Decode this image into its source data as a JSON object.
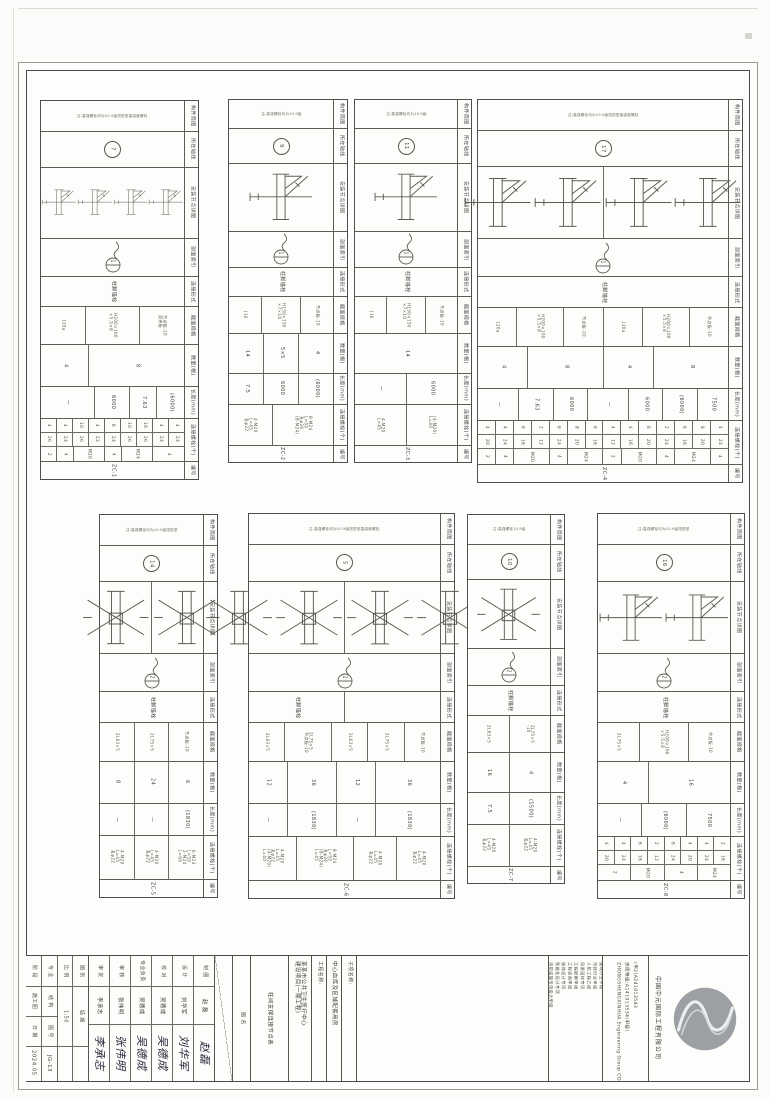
{
  "sheet": {
    "ink": "#4a4a48",
    "paper": "#fdfdfb",
    "logo_gray": "#9ca0a4"
  },
  "band_labels": [
    "构件简图",
    "所在轴线",
    "安装节点详图",
    "剖面索引",
    "连接形式",
    "截面规格",
    "数量(根)",
    "长度(mm)",
    "连接螺栓(个)",
    "编号"
  ],
  "tables": [
    {
      "x": 40,
      "y": 100,
      "w": 157,
      "h": 378,
      "axis": "7",
      "cut": "1",
      "note": "注:高强螺栓均为10.9级扭剪型高强度螺栓",
      "conn": [
        "柱脚锚栓"
      ],
      "sketch": {
        "type": "corner",
        "count": 4,
        "divider": false
      },
      "sections": [
        {
          "w": 1,
          "lines": [
            "[20a"
          ]
        },
        {
          "w": 1.2,
          "lines": [
            "H200×100",
            "×5.5×8"
          ]
        },
        {
          "w": 1,
          "lines": [
            "节点板-10",
            "双夹板"
          ]
        }
      ],
      "qty": [
        {
          "w": 1,
          "t": "4"
        },
        {
          "w": 2,
          "t": "8"
        }
      ],
      "len": [
        {
          "w": 1.6,
          "t": "—"
        },
        {
          "w": 1,
          "t": "6000"
        },
        {
          "w": 0.8,
          "t": "7.63"
        },
        {
          "w": 0.8,
          "t": "(6000)"
        }
      ],
      "bolts": {
        "style": "grid",
        "r1": [
          "4",
          "4",
          "10",
          "4",
          "6",
          "10",
          "16",
          "4",
          "4"
        ],
        "r2": [
          "20",
          "24",
          "20",
          "22",
          "24",
          "20",
          "20",
          "24",
          "24"
        ],
        "r3": [
          {
            "t": "2",
            "s": 1
          },
          {
            "t": "4",
            "s": 1
          },
          {
            "t": "M20",
            "s": 2
          },
          {
            "t": "4",
            "s": 1
          },
          {
            "t": "M24",
            "s": 2
          },
          {
            "t": "4",
            "s": 2
          }
        ]
      },
      "code": "ZC-1"
    },
    {
      "x": 228,
      "y": 99,
      "w": 118,
      "h": 362,
      "axis": "9",
      "cut": "1",
      "note": "注:高强螺栓均为10.9级",
      "conn": [
        "柱脚锚栓"
      ],
      "sketch": {
        "type": "corner",
        "count": 1,
        "divider": false
      },
      "sections": [
        {
          "w": 1,
          "lines": [
            "[16"
          ]
        },
        {
          "w": 1.2,
          "lines": [
            "H150×150",
            "×7×10"
          ]
        },
        {
          "w": 1,
          "lines": [
            "节点板-10"
          ]
        }
      ],
      "qty": [
        {
          "w": 1,
          "t": "14"
        },
        {
          "w": 1,
          "t": "5×5"
        },
        {
          "w": 1,
          "t": "4"
        }
      ],
      "len": [
        {
          "w": 1,
          "t": "7.5"
        },
        {
          "w": 1,
          "t": "6000"
        },
        {
          "w": 1,
          "t": "(6000)"
        }
      ],
      "bolts": {
        "style": "text",
        "cells": [
          {
            "w": 1,
            "lines": [
              "4-M20",
              "L=45",
              "孔φ22"
            ]
          },
          {
            "w": 1.4,
            "lines": [
              "8-M24",
              "L=50",
              "孔φ26",
              "(8-M24)"
            ]
          }
        ]
      },
      "code": "ZC-2"
    },
    {
      "x": 354,
      "y": 99,
      "w": 116,
      "h": 362,
      "axis": "11",
      "cut": "1",
      "note": "注:高强螺栓均为10.9级",
      "conn": [
        "柱脚锚栓"
      ],
      "sketch": {
        "type": "corner",
        "count": 1,
        "divider": false
      },
      "sections": [
        {
          "w": 1,
          "lines": [
            "[16"
          ]
        },
        {
          "w": 1.2,
          "lines": [
            "H150×150",
            "×7×10"
          ]
        },
        {
          "w": 1,
          "lines": [
            "节点板-10"
          ]
        }
      ],
      "qty": [
        {
          "w": 1,
          "t": "14"
        }
      ],
      "len": [
        {
          "w": 1,
          "t": "—"
        },
        {
          "w": 1,
          "t": "6000"
        }
      ],
      "bolts": {
        "style": "text",
        "cells": [
          {
            "w": 1,
            "lines": [
              "4-M20",
              "L=45"
            ]
          },
          {
            "w": 1,
            "lines": [
              "(4-M20)",
              "L=40"
            ]
          }
        ]
      },
      "code": "ZC-3"
    },
    {
      "x": 477,
      "y": 99,
      "w": 264,
      "h": 382,
      "axis": "17",
      "cut": "1",
      "note": "注:高强螺栓均为10.9级扭剪型高强度螺栓",
      "conn": [
        "柱脚锚栓"
      ],
      "sketch": {
        "type": "corner",
        "count": 4,
        "divider": true
      },
      "sections": [
        {
          "w": 1,
          "lines": [
            "[20a"
          ]
        },
        {
          "w": 1.2,
          "lines": [
            "H200×100",
            "×5.5×8"
          ]
        },
        {
          "w": 1,
          "lines": [
            "节点板-10"
          ]
        },
        {
          "w": 1,
          "lines": [
            "[20a"
          ]
        },
        {
          "w": 1.2,
          "lines": [
            "H200×100",
            "×5.5×8"
          ]
        },
        {
          "w": 1,
          "lines": [
            "节点板-10"
          ]
        }
      ],
      "qty": [
        {
          "w": 1,
          "t": "4"
        },
        {
          "w": 1.5,
          "t": "8"
        },
        {
          "w": 1,
          "t": "4"
        },
        {
          "w": 1.5,
          "t": "8"
        }
      ],
      "len": [
        {
          "w": 1.2,
          "t": "—"
        },
        {
          "w": 1,
          "t": "7.63"
        },
        {
          "w": 1,
          "t": "6000"
        },
        {
          "w": 1.2,
          "t": "—"
        },
        {
          "w": 1,
          "t": "6000"
        },
        {
          "w": 1,
          "t": "(6000)"
        },
        {
          "w": 0.9,
          "t": "7500"
        }
      ],
      "bolts": {
        "style": "grid",
        "r1": [
          "4",
          "4",
          "6",
          "2",
          "6",
          "8",
          "6",
          "4",
          "4",
          "6",
          "2",
          "6",
          "8",
          "4"
        ],
        "r2": [
          "20",
          "24",
          "16",
          "12",
          "24",
          "20",
          "16",
          "12",
          "16",
          "20",
          "24",
          "16",
          "20",
          "24"
        ],
        "r3": [
          {
            "t": "2",
            "s": 1
          },
          {
            "t": "4",
            "s": 1
          },
          {
            "t": "M20",
            "s": 2
          },
          {
            "t": "4",
            "s": 1
          },
          {
            "t": "M24",
            "s": 2
          },
          {
            "t": "2",
            "s": 1
          },
          {
            "t": "M20",
            "s": 2
          },
          {
            "t": "4",
            "s": 1
          },
          {
            "t": "M24",
            "s": 2
          },
          {
            "t": "4",
            "s": 1
          }
        ]
      },
      "code": "ZC-4"
    },
    {
      "x": 99,
      "y": 514,
      "w": 117,
      "h": 382,
      "axis": "14",
      "cut": "2",
      "note": "注:高强螺栓均为10.9级扭剪型",
      "conn": [
        "柱脚锚栓"
      ],
      "sketch": {
        "type": "cross",
        "count": 2,
        "divider": true
      },
      "sections": [
        {
          "w": 1,
          "lines": [
            "2L63×5"
          ]
        },
        {
          "w": 1,
          "lines": [
            "2L75×5"
          ]
        },
        {
          "w": 1,
          "lines": [
            "节点板-10"
          ]
        }
      ],
      "qty": [
        {
          "w": 1,
          "t": "8"
        },
        {
          "w": 1,
          "t": "24"
        },
        {
          "w": 1,
          "t": "6"
        }
      ],
      "len": [
        {
          "w": 1,
          "t": "—"
        },
        {
          "w": 1,
          "t": "—"
        },
        {
          "w": 1,
          "t": "(1830)"
        }
      ],
      "bolts": {
        "style": "text",
        "cells": [
          {
            "w": 1,
            "lines": [
              "4-M20",
              "L=45",
              "孔φ22"
            ]
          },
          {
            "w": 1,
            "lines": [
              "4-M20",
              "L=45",
              "孔φ22"
            ]
          },
          {
            "w": 1,
            "lines": [
              "6-M24",
              "L=50",
              "2-M24",
              "L=60"
            ]
          }
        ]
      },
      "code": "ZC-5"
    },
    {
      "x": 248,
      "y": 513,
      "w": 205,
      "h": 384,
      "axis": "5",
      "cut": "2",
      "note": "注:高强螺栓均为10.9级扭剪型高强度螺栓",
      "conn": [
        "柱脚锚栓",
        ""
      ],
      "sketch": {
        "type": "cross",
        "count": 4,
        "divider": true
      },
      "sections": [
        {
          "w": 1,
          "lines": [
            "2L63×5"
          ]
        },
        {
          "w": 1.3,
          "lines": [
            "2L75×5",
            "节点板-10"
          ]
        },
        {
          "w": 1,
          "lines": [
            "2L63×5"
          ]
        },
        {
          "w": 1,
          "lines": [
            "2L75×5"
          ]
        },
        {
          "w": 1,
          "lines": [
            "节点板-10"
          ]
        }
      ],
      "qty": [
        {
          "w": 1,
          "t": "12"
        },
        {
          "w": 1.3,
          "t": "36"
        },
        {
          "w": 1,
          "t": "12"
        },
        {
          "w": 1.7,
          "t": "36"
        }
      ],
      "len": [
        {
          "w": 1,
          "t": "—"
        },
        {
          "w": 1.3,
          "t": "(1830)"
        },
        {
          "w": 1,
          "t": "—"
        },
        {
          "w": 1.7,
          "t": "(1830)"
        }
      ],
      "bolts": {
        "style": "text",
        "cells": [
          {
            "w": 1.1,
            "lines": [
              "4-M20",
              "L=45",
              "孔φ22",
              "(4-M20)",
              "L=40"
            ]
          },
          {
            "w": 1.3,
            "lines": [
              "8-M24",
              "L=50",
              "孔φ26",
              "(8-M24)",
              "L=45"
            ]
          },
          {
            "w": 1,
            "lines": [
              "4-M20",
              "L=45",
              "孔φ22"
            ]
          },
          {
            "w": 1,
            "lines": [
              "4-M20",
              "L=45",
              "孔φ22"
            ]
          }
        ]
      },
      "code": "ZC-6"
    },
    {
      "x": 467,
      "y": 514,
      "w": 96,
      "h": 368,
      "axis": "10",
      "cut": "2",
      "note": "注:高强螺栓10.9级",
      "conn": [
        "柱脚锚栓"
      ],
      "sketch": {
        "type": "cross",
        "count": 1,
        "divider": false
      },
      "sections": [
        {
          "w": 1,
          "lines": [
            "2L63×5"
          ]
        },
        {
          "w": 1,
          "lines": [
            "2L75×5",
            "-10"
          ]
        }
      ],
      "qty": [
        {
          "w": 1,
          "t": "16"
        },
        {
          "w": 1,
          "t": "4"
        }
      ],
      "len": [
        {
          "w": 1,
          "t": "7.5"
        },
        {
          "w": 1,
          "t": "(1500)"
        }
      ],
      "bolts": {
        "style": "text",
        "cells": [
          {
            "w": 1,
            "lines": [
              "4-M20",
              "L=45",
              "孔φ22"
            ]
          },
          {
            "w": 1,
            "lines": [
              "4-M20",
              "L=45",
              "孔φ22"
            ]
          }
        ]
      },
      "code": "ZC-7"
    },
    {
      "x": 597,
      "y": 513,
      "w": 146,
      "h": 384,
      "axis": "16",
      "cut": "2",
      "note": "注:高强螺栓均为10.9级扭剪型",
      "conn": [
        "柱脚锚栓"
      ],
      "sketch": {
        "type": "corner",
        "count": 2,
        "divider": false
      },
      "sections": [
        {
          "w": 1,
          "lines": [
            "2L75×5"
          ]
        },
        {
          "w": 1.2,
          "lines": [
            "H200×100",
            "×5.5×8"
          ]
        },
        {
          "w": 1,
          "lines": [
            "节点板-10"
          ]
        }
      ],
      "qty": [
        {
          "w": 1,
          "t": "4"
        },
        {
          "w": 1.6,
          "t": "16"
        }
      ],
      "len": [
        {
          "w": 1,
          "t": "—"
        },
        {
          "w": 1,
          "t": "(6000)"
        },
        {
          "w": 1,
          "t": "7500"
        }
      ],
      "bolts": {
        "style": "grid",
        "r1": [
          "4",
          "4",
          "6",
          "2",
          "6",
          "4",
          "4",
          "2"
        ],
        "r2": [
          "20",
          "24",
          "16",
          "12",
          "24",
          "20",
          "24",
          "16"
        ],
        "r3": [
          {
            "t": "2",
            "s": 2
          },
          {
            "t": "M20",
            "s": 2
          },
          {
            "t": "4",
            "s": 2
          },
          {
            "t": "M24",
            "s": 2
          }
        ]
      },
      "code": "ZC-8"
    }
  ],
  "titleblock": {
    "info_grid": [
      {
        "cells": [
          {
            "t": "阶 段",
            "h": 30
          },
          {
            "t": "施工图",
            "h": 30
          },
          {
            "t": "日 期",
            "h": 30
          },
          {
            "t": "2024.05",
            "h": 33
          }
        ]
      },
      {
        "cells": [
          {
            "t": "专 业",
            "h": 30
          },
          {
            "t": "结 构",
            "h": 30
          },
          {
            "t": "图 号",
            "h": 30
          },
          {
            "t": "JG-13",
            "h": 33
          }
        ]
      },
      {
        "cells": [
          {
            "t": "比 例",
            "h": 30
          },
          {
            "t": "1:50",
            "h": 60
          },
          {
            "t": "",
            "h": 33
          }
        ]
      },
      {
        "cells": [
          {
            "t": "图 别",
            "h": 30
          },
          {
            "t": "结 施",
            "h": 60
          },
          {
            "t": "",
            "h": 33
          }
        ]
      }
    ],
    "signatures": [
      {
        "role": "审 定",
        "name": "李承志",
        "sig": "李承志"
      },
      {
        "role": "审 核",
        "name": "张伟明",
        "sig": "张伟明"
      },
      {
        "role": "专业负责",
        "name": "吴德成",
        "sig": "吴德成"
      },
      {
        "role": "校 对",
        "name": "吴德成",
        "sig": "吴德成"
      },
      {
        "role": "设 计",
        "name": "刘华军",
        "sig": "刘华军"
      },
      {
        "role": "制 图",
        "name": "赵 磊",
        "sig": "赵磊"
      }
    ],
    "drawing_title_label": "图 名",
    "drawing_title": "柱间支撑连接节点表",
    "project_label": "工程名称:",
    "project_lines": [
      "某某市公共卫生医疗中心",
      "建设项目(一期工程)"
    ],
    "subproject_label": "子项名称:",
    "subproject": "中心血库及区域配套用房",
    "quals": [
      "综合甲级",
      "建筑行业甲级",
      "市政行业甲级",
      "人防工程乙级",
      "风景园林专项",
      "工程勘察甲级",
      "工程咨询甲级",
      "装饰设计专项",
      "智能化设计专项",
      "消防设施专项设计甲级",
      "建设工程施工图设计文件审查机构"
    ],
    "certs": [
      "(甲2)A241013543",
      "资质等级:A141013534(甲级)",
      "ZHONGSHENGXINHUA Engineering Group CO.,LTD"
    ],
    "company_cn": "中国中元国际工程有限公司"
  }
}
